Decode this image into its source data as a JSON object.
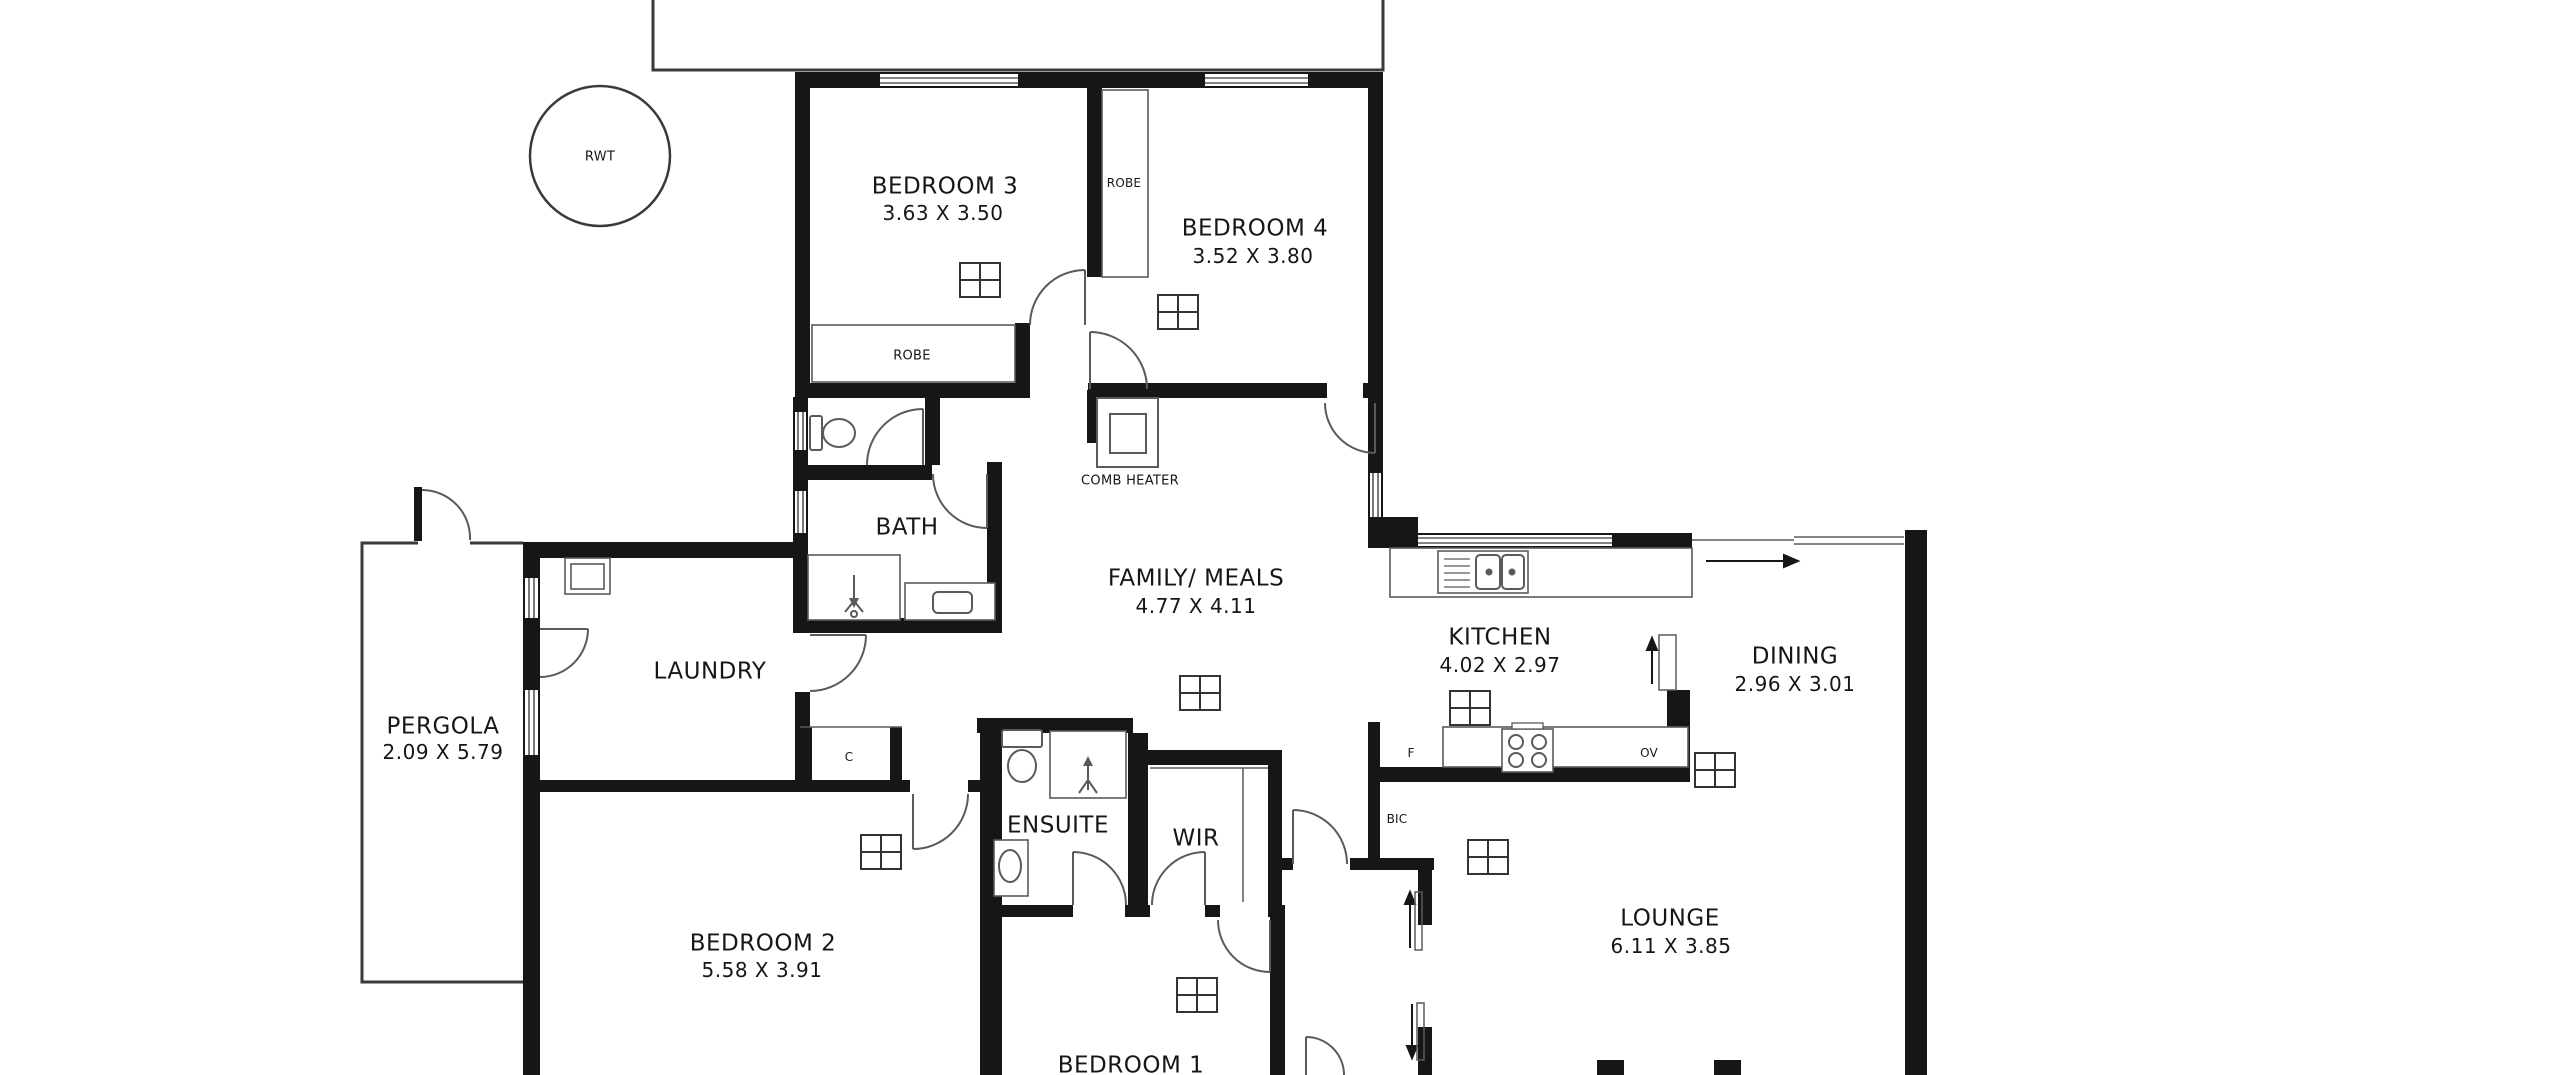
{
  "floorplan": {
    "rooms": [
      {
        "name": "BEDROOM 3",
        "dims": "3.63 X 3.50"
      },
      {
        "name": "BEDROOM 4",
        "dims": "3.52 X 3.80"
      },
      {
        "name": "BATH"
      },
      {
        "name": "FAMILY/ MEALS",
        "dims": "4.77 X 4.11"
      },
      {
        "name": "KITCHEN",
        "dims": "4.02 X 2.97"
      },
      {
        "name": "DINING",
        "dims": "2.96 X 3.01"
      },
      {
        "name": "LAUNDRY"
      },
      {
        "name": "PERGOLA",
        "dims": "2.09 X 5.79"
      },
      {
        "name": "ENSUITE"
      },
      {
        "name": "WIR"
      },
      {
        "name": "BEDROOM 2",
        "dims": "5.58 X 3.91"
      },
      {
        "name": "LOUNGE",
        "dims": "6.11 X 3.85"
      },
      {
        "name": "BEDROOM 1"
      }
    ],
    "labels": {
      "rwt": "RWT",
      "robe_bed3": "ROBE",
      "robe_bed4": "ROBE",
      "comb_heater": "COMB HEATER",
      "cupboard": "C",
      "fridge": "F",
      "oven": "OV",
      "bic": "BIC"
    }
  }
}
